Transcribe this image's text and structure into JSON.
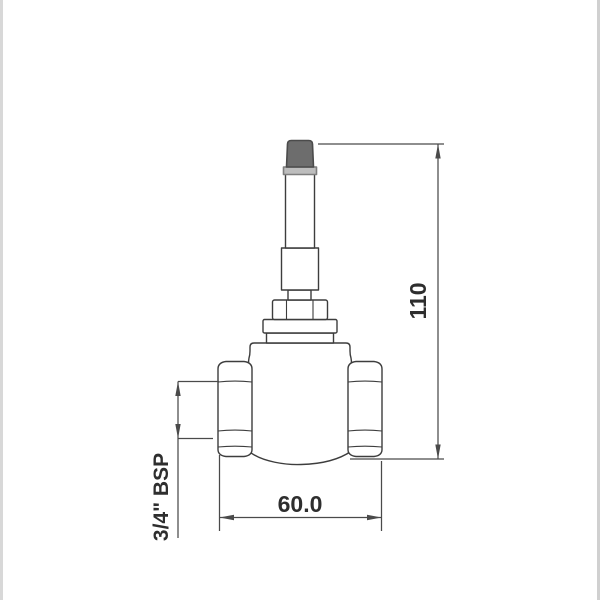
{
  "drawing": {
    "kind": "valve-technical-drawing",
    "labels": {
      "height_dim": "110",
      "width_dim": "60.0",
      "thread_dim": "3/4\" BSP"
    },
    "colors": {
      "line": "#3d3d3d",
      "dimension_line": "#4a4a4a",
      "text": "#2e2e2e",
      "cap_fill": "#6d6d6d",
      "cap_border": "#4b4b4b",
      "cap_base_fill": "#bdbdbd",
      "cap_base_border": "#7e7e7e",
      "page_edge_strip": "#d8d8d8",
      "background": "#ffffff"
    }
  }
}
